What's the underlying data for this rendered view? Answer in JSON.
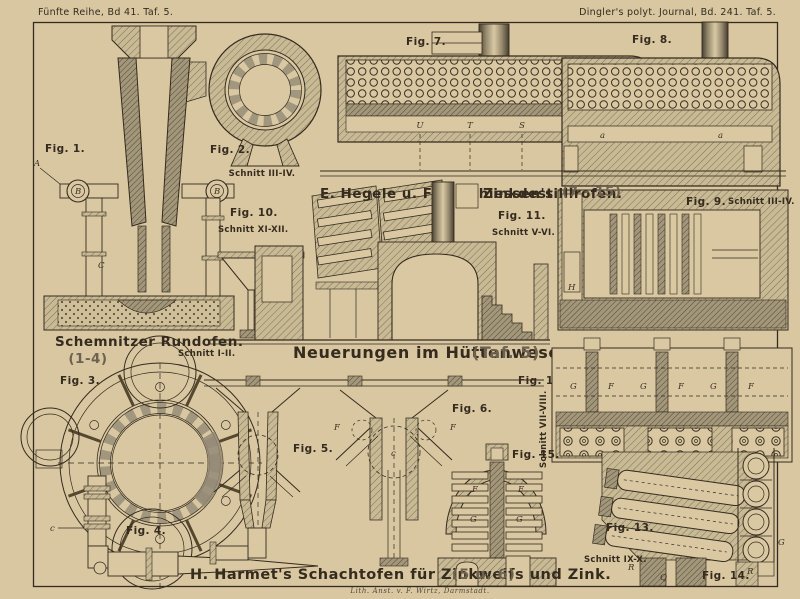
{
  "plate": {
    "margin_left": "Fünfte Reihe, Bd 41. Taf. 5.",
    "margin_right": "Dingler's polyt. Journal, Bd. 241. Taf. 5.",
    "main_title": "Neuerungen im Hüttenwesen.",
    "main_title_ref": "(Taf. 5)",
    "credit": "Lith. Anst. v. F. Wirtz, Darmstadt."
  },
  "sections": {
    "rundofen": {
      "title": "Schemnitzer Rundofen.",
      "figs": "(1-4)"
    },
    "destillirofen": {
      "author": "E. Hegele u. F. Matthiessen's",
      "title": "Zinkdestillirofen.",
      "figs": "(7 - 15)"
    },
    "schachtofen": {
      "title": "H. Harmet's Schachtofen für Zinkweiſs und Zink.",
      "figs": "(5 u. 6)"
    }
  },
  "figures": {
    "fig1": {
      "label": "Fig. 1.",
      "letters": [
        "A",
        "B",
        "B",
        "C"
      ]
    },
    "fig2": {
      "label": "Fig. 2.",
      "schnitt": "Schnitt III-IV."
    },
    "fig3": {
      "label": "Fig. 3.",
      "schnitt": "Schnitt I-II."
    },
    "fig4": {
      "label": "Fig. 4.",
      "letters": [
        "c"
      ]
    },
    "fig5": {
      "label": "Fig. 5."
    },
    "fig6": {
      "label": "Fig. 6.",
      "letters": [
        "F",
        "F",
        "c"
      ]
    },
    "fig7": {
      "label": "Fig. 7.",
      "letters": [
        "U",
        "T",
        "S",
        "R"
      ]
    },
    "fig8": {
      "label": "Fig. 8.",
      "letters": [
        "a",
        "a"
      ]
    },
    "fig9": {
      "label": "Fig. 9.",
      "schnitt": "Schnitt III-IV.",
      "letters": [
        "H"
      ]
    },
    "fig10": {
      "label": "Fig. 10.",
      "schnitt": "Schnitt XI-XII."
    },
    "fig11": {
      "label": "Fig. 11.",
      "schnitt": "Schnitt V-VI."
    },
    "fig12": {
      "label": "Fig. 12.",
      "schnitt": "Schnitt VII-VIII.",
      "letters": [
        "G",
        "F",
        "G",
        "F",
        "G",
        "F"
      ]
    },
    "fig13": {
      "label": "Fig. 13.",
      "schnitt": "Schnitt IX-X.",
      "letters": [
        "R",
        "Q"
      ]
    },
    "fig14": {
      "label": "Fig. 14.",
      "letters": [
        "R",
        "G"
      ]
    },
    "fig15": {
      "label": "Fig. 15.",
      "letters": [
        "F",
        "F",
        "G",
        "G"
      ]
    }
  },
  "colors": {
    "paper": "#d9c8a2",
    "ink": "#352b1e",
    "wall_light": "#c8ba94",
    "wall_dark": "#ab9f83"
  }
}
